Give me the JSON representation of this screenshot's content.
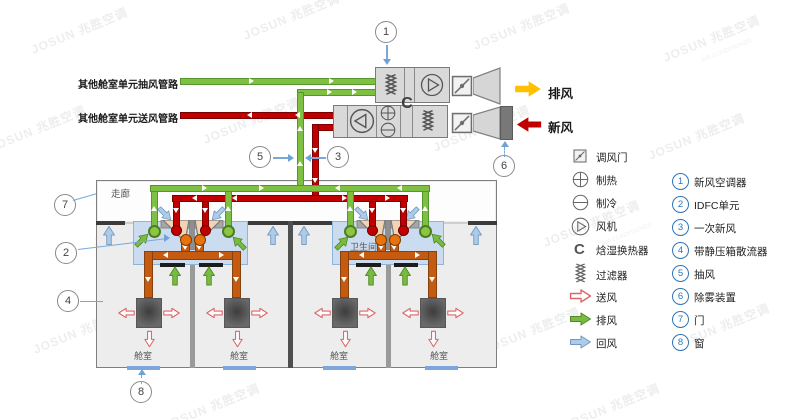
{
  "labels": {
    "other_cabin_exhaust_line": "其他舱室单元抽风管路",
    "other_cabin_supply_line": "其他舱室单元送风管路",
    "exhaust_out": "排风",
    "fresh_air_in": "新风",
    "corridor": "走廊",
    "bathroom": "卫生间",
    "cabin": "舱室",
    "enthalpy_symbol": "C"
  },
  "callouts": {
    "c1": "1",
    "c2": "2",
    "c3": "3",
    "c4": "4",
    "c5": "5",
    "c6": "6",
    "c7": "7",
    "c8": "8"
  },
  "legend": {
    "symbols": [
      {
        "icon": "damper-icon",
        "label": "调风门"
      },
      {
        "icon": "heating-icon",
        "label": "制热"
      },
      {
        "icon": "cooling-icon",
        "label": "制冷"
      },
      {
        "icon": "fan-icon",
        "label": "风机"
      },
      {
        "icon": "enthalpy-exchanger-icon",
        "label": "焓湿换热器",
        "symbol": "C"
      },
      {
        "icon": "filter-icon",
        "label": "过滤器"
      },
      {
        "icon": "supply-air-arrow-icon",
        "label": "送风"
      },
      {
        "icon": "exhaust-air-arrow-icon",
        "label": "排风"
      },
      {
        "icon": "return-air-arrow-icon",
        "label": "回风"
      }
    ],
    "numbered": [
      {
        "num": "1",
        "label": "新风空调器"
      },
      {
        "num": "2",
        "label": "IDFC单元"
      },
      {
        "num": "3",
        "label": "一次新风"
      },
      {
        "num": "4",
        "label": "带静压箱散流器"
      },
      {
        "num": "5",
        "label": "抽风"
      },
      {
        "num": "6",
        "label": "除雾装置"
      },
      {
        "num": "7",
        "label": "门"
      },
      {
        "num": "8",
        "label": "窗"
      }
    ]
  },
  "watermark": {
    "text": "JOSUN 兆胜空调",
    "subtext": "AIR CONDITIONER"
  },
  "colors": {
    "exhaust_pipe_green": "#7EC142",
    "supply_pipe_red": "#C00000",
    "duct_orange": "#C55A11",
    "exhaust_out_arrow_yellow": "#FFC000",
    "fresh_in_arrow_red": "#C00000",
    "idfc_box_blue": "#CBDCF0",
    "return_air_blue": "#AECBE8",
    "exhaust_air_green": "#79BA43",
    "supply_air_pink": "#DD6666",
    "legend_number_blue": "#2E75B6"
  }
}
